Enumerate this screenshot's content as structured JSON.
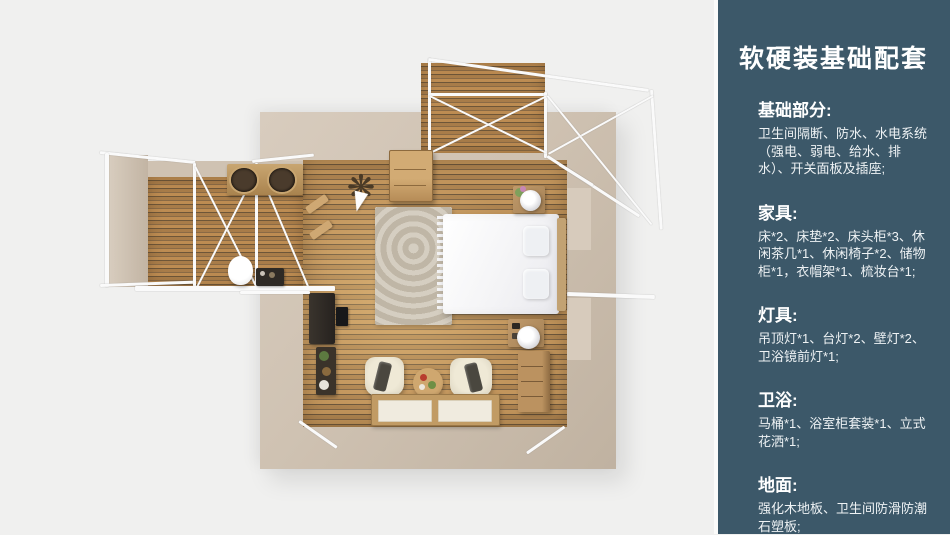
{
  "colors": {
    "page_background": "#f0f0ef",
    "sidebar_background": "#3c5869",
    "wall_beige": "#cfc2b2",
    "wood_floor": "#c2955c",
    "deck_wood": "#b3854f",
    "bed_white": "#f7f7f9",
    "text_white": "#ffffff"
  },
  "sidebar": {
    "title": "软硬装基础配套",
    "sections": [
      {
        "heading": "基础部分:",
        "body": "卫生间隔断、防水、水电系统（强电、弱电、给水、排水）、开关面板及插座;"
      },
      {
        "heading": "家具:",
        "body": "床*2、床垫*2、床头柜*3、休闲茶几*1、休闲椅子*2、储物柜*1，衣帽架*1、梳妆台*1;"
      },
      {
        "heading": "灯具:",
        "body": "吊顶灯*1、台灯*2、壁灯*2、卫浴镜前灯*1;"
      },
      {
        "heading": "卫浴:",
        "body": "马桶*1、浴室柜套装*1、立式花洒*1;"
      },
      {
        "heading": "地面:",
        "body": "强化木地板、卫生间防滑防潮石塑板;"
      }
    ]
  },
  "floor_plan": {
    "coat_rack_glyph": "❋"
  }
}
